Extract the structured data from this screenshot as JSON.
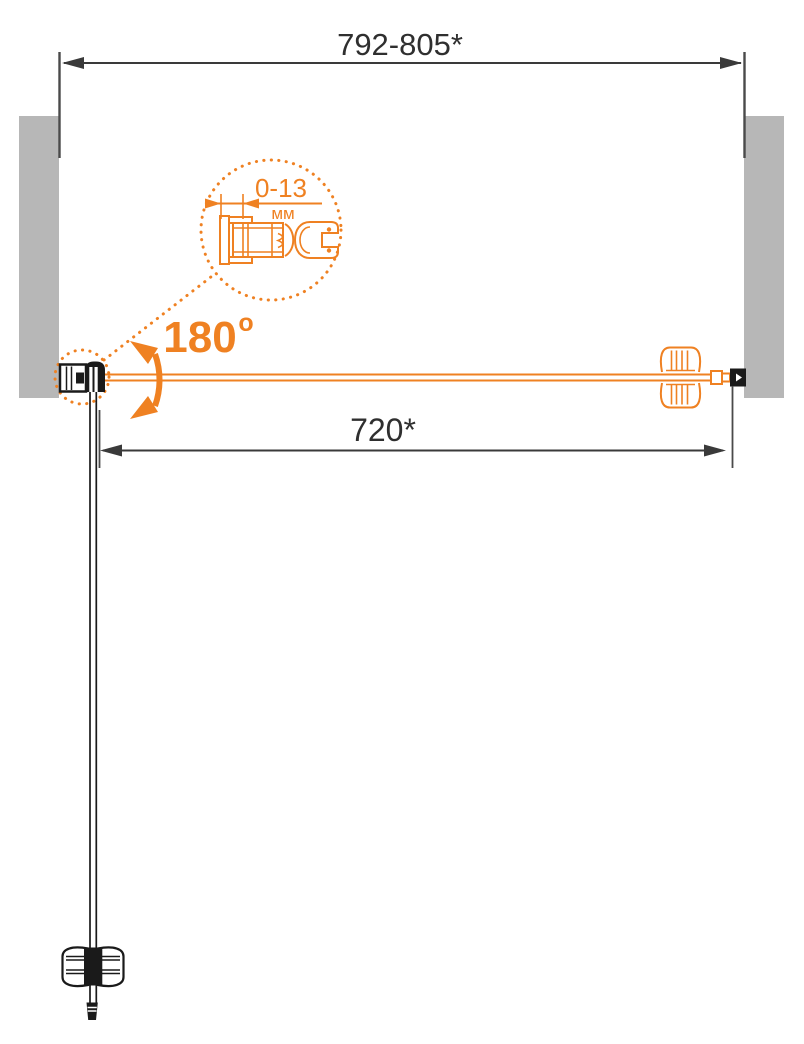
{
  "diagram": {
    "type": "shower-door-plan-view-technical-drawing",
    "dimensions": {
      "overall_width": "792-805*",
      "door_width": "720*",
      "profile_adjustment_range": "0-13",
      "profile_adjustment_unit": "мм",
      "door_swing_angle": "180",
      "door_swing_angle_sup": "o"
    },
    "colors": {
      "accent_orange": "#ef8122",
      "dimension_line": "#3a3a3a",
      "wall_gray": "#b7b7b7",
      "drawing_black": "#1a1a1a",
      "background": "#ffffff"
    }
  }
}
